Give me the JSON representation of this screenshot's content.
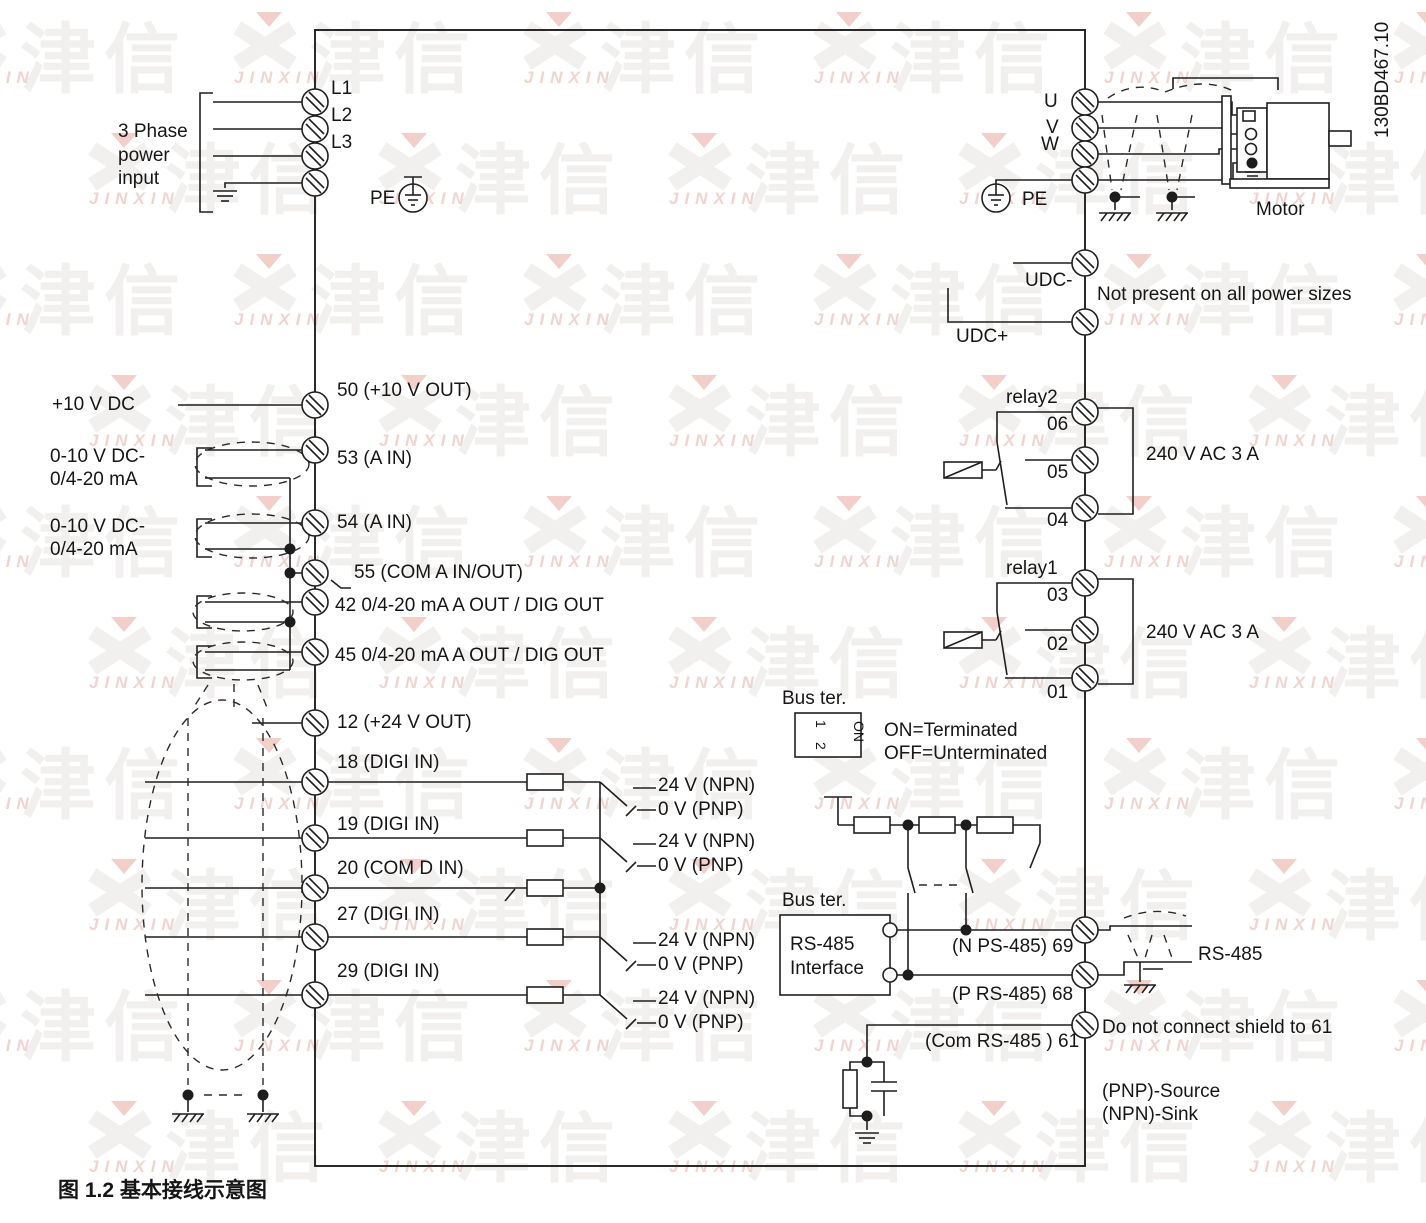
{
  "watermark": {
    "cn": "津信",
    "en": "JINXIN"
  },
  "doc_code": "130BD467.10",
  "caption": "图 1.2 基本接线示意图",
  "power_input": {
    "label_lines": [
      "3 Phase",
      "power",
      "input"
    ],
    "l1": "L1",
    "l2": "L2",
    "l3": "L3",
    "pe": "PE"
  },
  "motor_section": {
    "u": "U",
    "v": "V",
    "w": "W",
    "pe": "PE",
    "motor": "Motor"
  },
  "dc_bus": {
    "udc_minus": "UDC-",
    "udc_plus": "UDC+",
    "note": "Not present on all power sizes"
  },
  "analog": {
    "supply": "+10 V DC",
    "t50": "50 (+10 V OUT)",
    "ain1_l1": "0-10 V DC-",
    "ain1_l2": "0/4-20 mA",
    "t53": "53 (A IN)",
    "ain2_l1": "0-10 V DC-",
    "ain2_l2": "0/4-20 mA",
    "t54": "54 (A IN)",
    "t55": "55 (COM A IN/OUT)",
    "t42": "42 0/4-20 mA A OUT / DIG OUT",
    "t45": "45 0/4-20 mA A OUT / DIG OUT"
  },
  "digital": {
    "t12": "12 (+24 V OUT)",
    "t18": "18 (DIGI IN)",
    "t19": "19 (DIGI IN)",
    "t20": "20 (COM D IN)",
    "t27": "27 (DIGI IN)",
    "t29": "29 (DIGI IN)",
    "npn": "24 V (NPN)",
    "pnp": "0 V (PNP)"
  },
  "relay2": {
    "name": "relay2",
    "t06": "06",
    "t05": "05",
    "t04": "04",
    "rating": "240 V AC 3 A"
  },
  "relay1": {
    "name": "relay1",
    "t03": "03",
    "t02": "02",
    "t01": "01",
    "rating": "240 V AC 3 A"
  },
  "bus_term": {
    "label": "Bus ter.",
    "dip_1": "1",
    "dip_2": "2",
    "dip_on": "ON",
    "on_text": "ON=Terminated",
    "off_text": "OFF=Unterminated"
  },
  "rs485": {
    "bus_ter_label": "Bus ter.",
    "box_line1": "RS-485",
    "box_line2": "Interface",
    "t69": "(N PS-485) 69",
    "t68": "(P RS-485) 68",
    "t61": "(Com RS-485 ) 61",
    "shield_note": "Do not connect shield to 61",
    "bus_label": "RS-485",
    "pnp_note": "(PNP)-Source",
    "npn_note": "(NPN)-Sink"
  }
}
